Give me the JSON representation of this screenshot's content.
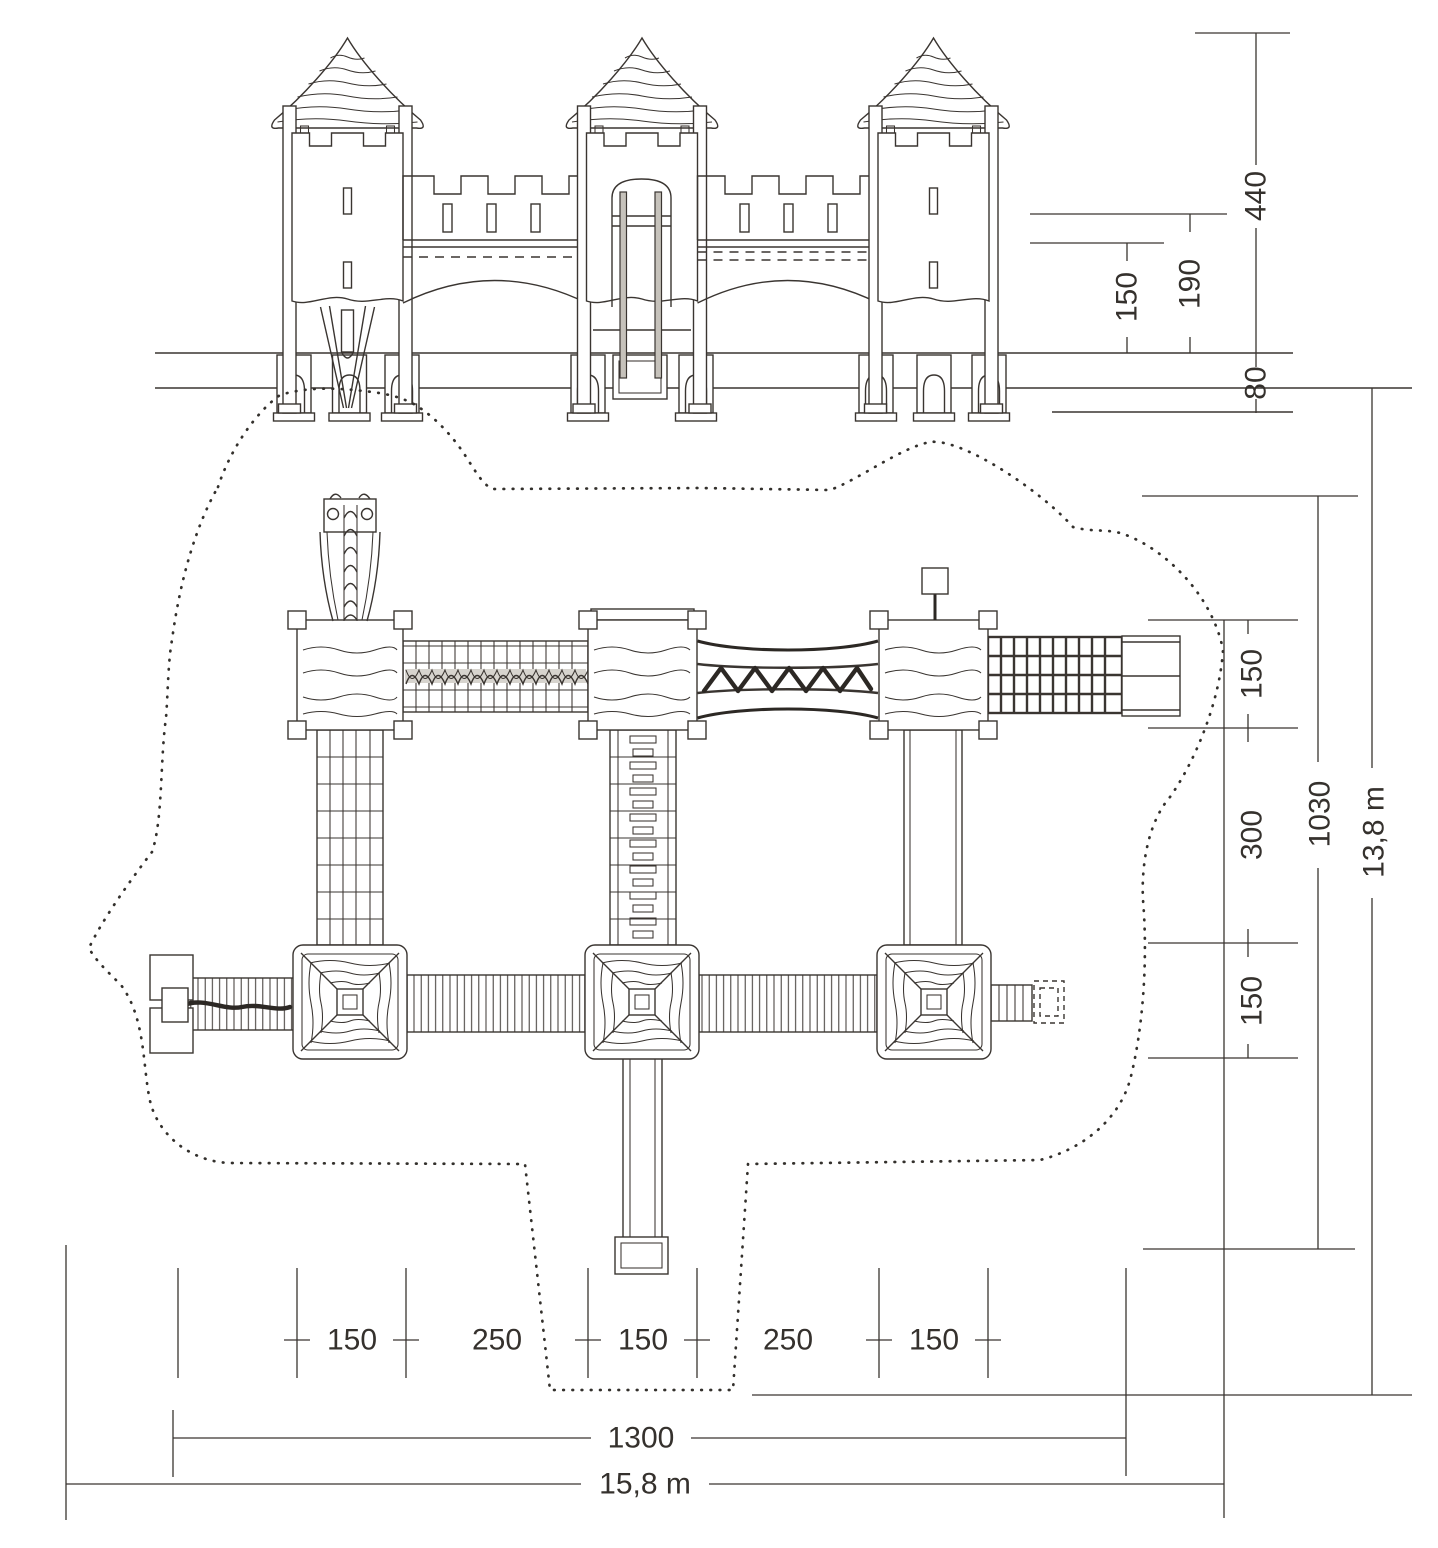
{
  "drawing_title": "Playground castle - elevation and plan technical drawing",
  "dimensions": {
    "elevation": {
      "overall_height": "440",
      "rail_height": "190",
      "deck_height": "150",
      "foundation_depth": "80"
    },
    "plan_vertical": {
      "top_row_depth": "150",
      "middle_span": "300",
      "bottom_row_depth": "150",
      "structure_depth": "1030",
      "safety_area_depth": "13,8 m"
    },
    "plan_horizontal": {
      "tower_left_width": "150",
      "bridge_left_span": "250",
      "tower_middle_width": "150",
      "bridge_right_span": "250",
      "tower_right_width": "150",
      "structure_width": "1300",
      "safety_area_width": "15,8 m"
    }
  }
}
